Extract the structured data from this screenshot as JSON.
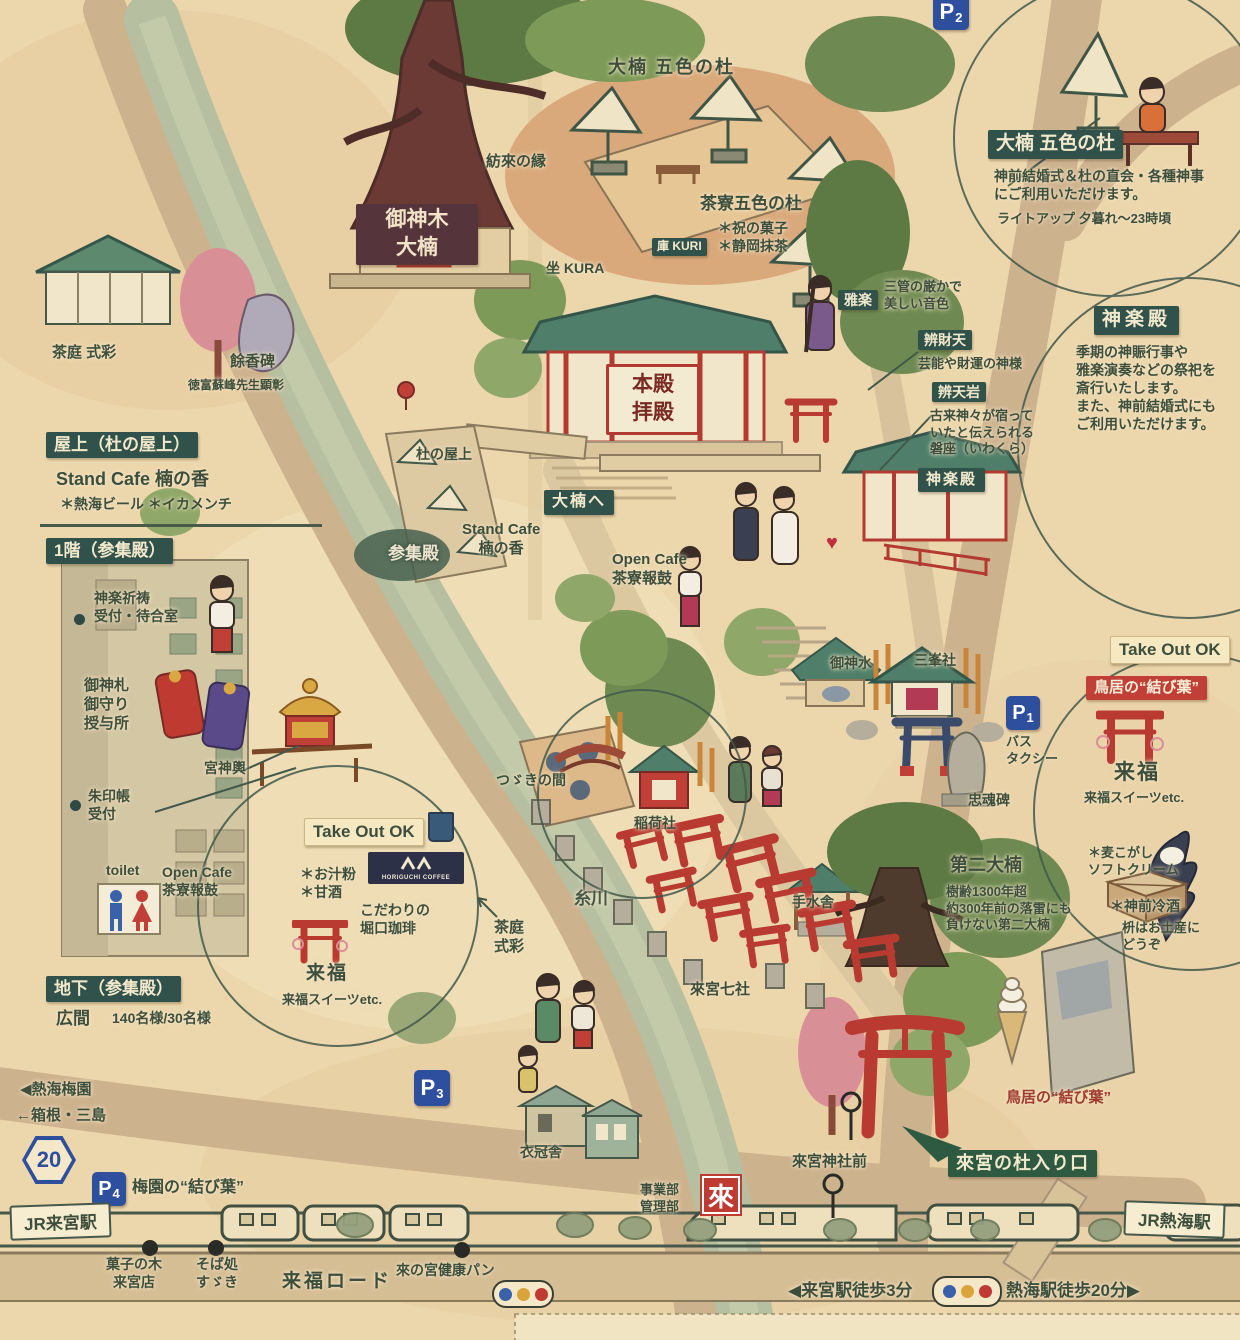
{
  "parking": {
    "p1": {
      "p": "P",
      "n": "1",
      "sub": "バス\nタクシー"
    },
    "p2": {
      "p": "P",
      "n": "2"
    },
    "p3": {
      "p": "P",
      "n": "3"
    },
    "p4": {
      "p": "P",
      "n": "4",
      "note": "梅園の“結び葉”"
    }
  },
  "route_badge": "20",
  "info_okusu": {
    "title": "大楠 五色の杜",
    "body": "神前結婚式＆杜の直会・各種神事\nにご利用いただけます。",
    "note": "ライトアップ 夕暮れ〜23時頃"
  },
  "info_kagura": {
    "title": "神楽殿",
    "body": "季期の神賑行事や\n雅楽演奏などの祭祀を\n斎行いたします。\nまた、神前結婚式にも\nご利用いただけます。"
  },
  "top": {
    "okusu_area": "大楠 五色の杜",
    "tsumugi": "紡來の縁",
    "saryo": "茶寮五色の杜",
    "saryo_items": "＊祝の菓子\n＊静岡抹茶",
    "kuri": "庫 KURI",
    "kura": "坐 KURA"
  },
  "shrine": {
    "goshinboku": "御神木\n大楠",
    "honden": "本殿\n拝殿",
    "gagaku": "雅楽",
    "gagaku_note": "三管の厳かで\n美しい音色",
    "benzaiten": "辨財天",
    "benzaiten_note": "芸能や財運の神様",
    "benteniwa": "辨天岩",
    "benteniwa_note": "古来神々が宿って\nいたと伝えられる\n磐座（いわくら）",
    "kaguraden": "神楽殿",
    "okusu_e": "大楠へ",
    "mori_okujo": "杜の屋上",
    "sanshuden": "参集殿",
    "stand_cafe": "Stand Cafe\n楠の香",
    "open_cafe": "Open Cafe\n茶寮報鼓"
  },
  "left": {
    "chatei": "茶庭 式彩",
    "yokouhi": "餘香碑",
    "yokouhi_note": "徳富蘇峰先生顕彰",
    "okujo_title": "屋上（杜の屋上）",
    "stand_cafe": "Stand Cafe 楠の香",
    "stand_cafe_items": "＊熱海ビール ＊イカメンチ",
    "ikkai_title": "1階（参集殿）",
    "kito": "神楽祈祷\n受付・待合室",
    "osatsu": "御神札\n御守り\n授与所",
    "mikoshi": "宮神輿",
    "shuin": "朱印帳\n受付",
    "toilet": "toilet",
    "open_cafe": "Open Cafe\n茶寮報鼓",
    "takeout": "Take Out OK",
    "oshiruko": "＊お汁粉\n＊甘酒",
    "coffee_logo": "HORIGUCHI COFFEE",
    "coffee_note": "こだわりの\n堀口珈琲",
    "raifuku": "来福",
    "raifuku_note": "来福スイーツetc.",
    "chika_title": "地下（参集殿）",
    "hiroma": "広間",
    "hiroma_cap": "140名様/30名様",
    "baien": "◀熱海梅園",
    "hakone": "←箱根・三島"
  },
  "center": {
    "tsuzuki": "つゞきの間",
    "inari": "稲荷社",
    "itogawa": "糸川",
    "chatei": "茶庭\n式彩",
    "nanasha": "來宮七社",
    "chozuya": "手水舎"
  },
  "right": {
    "goshinsui": "御神水",
    "mitsumine": "三峯社",
    "chukonhi": "忠魂碑",
    "daini": "第二大楠",
    "daini_note": "樹齢1300年超\n約300年前の落雷にも\n負けない第二大楠",
    "takeout": "Take Out OK",
    "torii_musubiba": "鳥居の“結び葉”",
    "raifuku": "来福",
    "raifuku_note": "来福スイーツetc.",
    "mugikogashi": "＊麦こがし\nソフトクリーム",
    "reishu": "＊神前冷酒",
    "masu_note": "枡はお土産に\nどうぞ"
  },
  "bottom": {
    "jr_kinomiya": "JR来宮駅",
    "kashinoki": "菓子の木\n来宮店",
    "soba": "そば処\nすゞき",
    "raifuku_road": "来福ロード",
    "kenko_pan": "來の宮健康パン",
    "jigyobu": "事業部\n管理部",
    "rai": "來",
    "jinja_mae": "來宮神社前",
    "walk_kinomiya": "◀来宮駅徒歩3分",
    "walk_atami": "熱海駅徒歩20分▶",
    "jr_atami": "JR熱海駅",
    "mori_entrance": "來宮の杜入り口",
    "ikansha": "衣冠舎",
    "torii_musubiba": "鳥居の“結び葉”"
  },
  "misc": {
    "heart": "♥"
  }
}
